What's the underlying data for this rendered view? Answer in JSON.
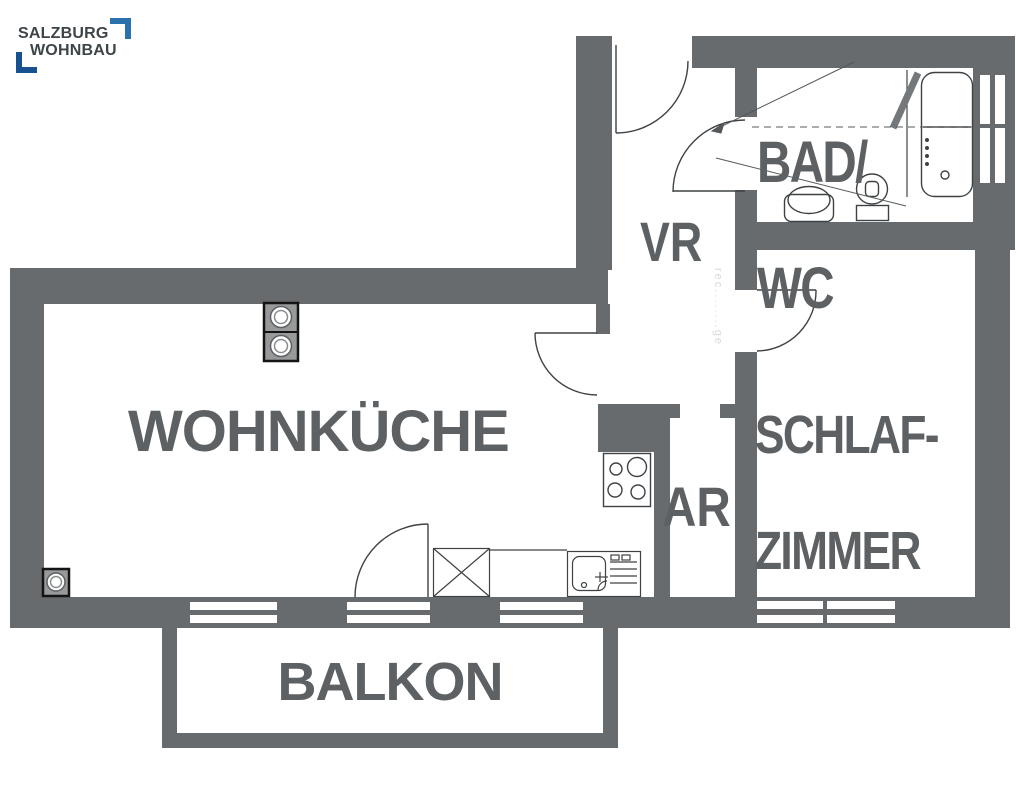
{
  "logo": {
    "line1": "SALZBURG",
    "line2": "WOHNBAU"
  },
  "rooms": {
    "wohnkueche": {
      "label": "WOHNKÜCHE"
    },
    "bad_wc": {
      "line1": "BAD/",
      "line2": "WC"
    },
    "vr": {
      "label": "VR"
    },
    "schlafzimmer": {
      "line1": "SCHLAF-",
      "line2": "ZIMMER"
    },
    "ar": {
      "label": "AR"
    },
    "balkon": {
      "label": "BALKON"
    }
  },
  "watermark": "rec........ge",
  "fixtures": [
    "bathtub",
    "toilet",
    "washbasin",
    "stove-hob",
    "kitchen-sink",
    "crossed-cabinet",
    "appliance-column",
    "corner-appliance",
    "entrance-door",
    "bathroom-door",
    "bedroom-door",
    "kitchen-door",
    "balcony-door",
    "window"
  ],
  "colors": {
    "wall": "#686b6d",
    "label_text": "#5d6163",
    "fixture_line": "#3f4244",
    "logo_text": "#3e4549",
    "logo_blue_top": "#2a72ad",
    "logo_blue_bottom": "#17518f",
    "watermark": "#d9d9d9",
    "background": "#ffffff"
  }
}
